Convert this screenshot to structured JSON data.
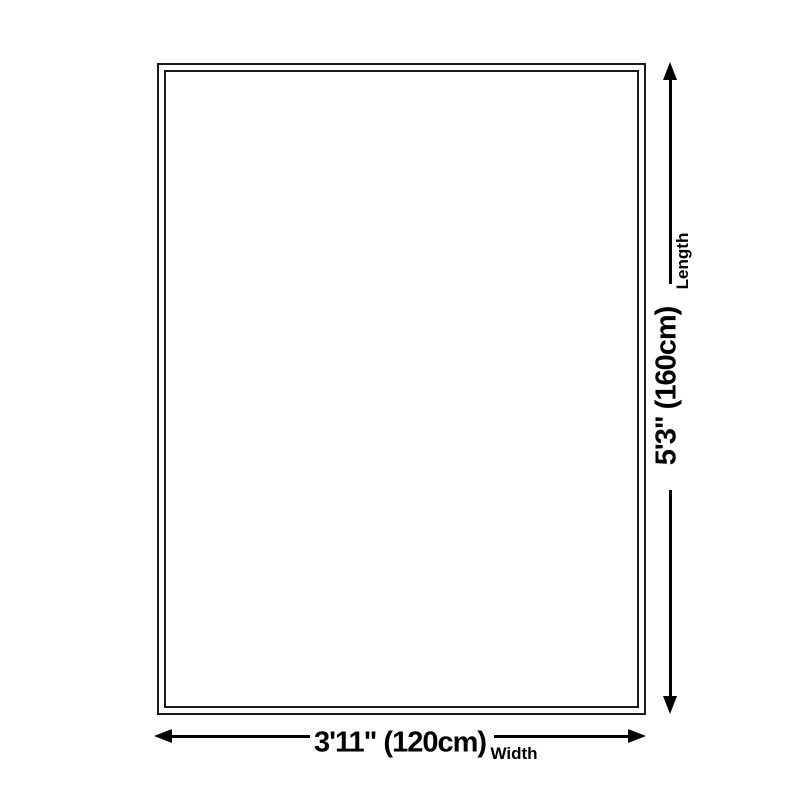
{
  "colors": {
    "background": "#ffffff",
    "rug_border": "#1b1b1b",
    "arrow": "#000000",
    "text": "#000000"
  },
  "dimensions": {
    "length": {
      "value": "5'3\" (160cm)",
      "label": "Length"
    },
    "width": {
      "value": "3'11\" (120cm)",
      "label": "Width"
    }
  }
}
